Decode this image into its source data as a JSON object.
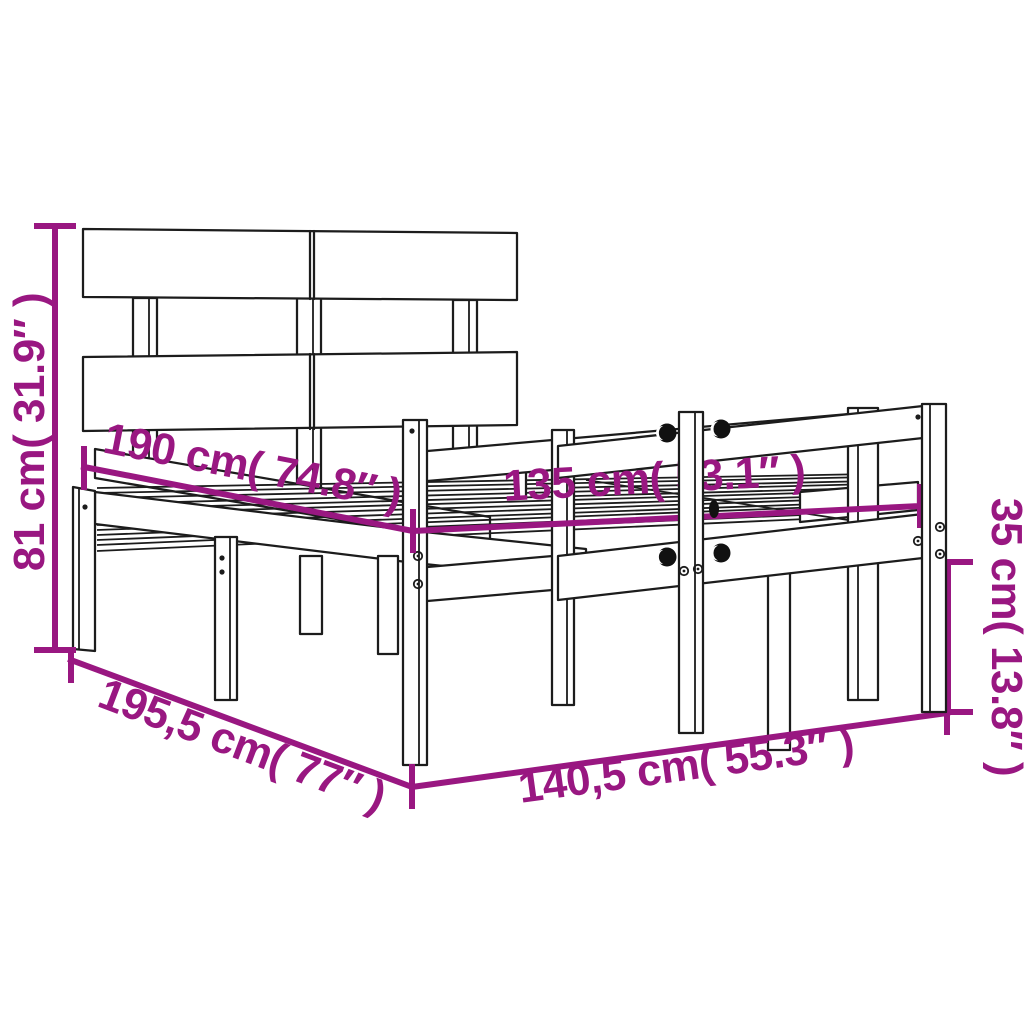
{
  "diagram": {
    "title": "Bed frame dimension drawing",
    "subject": "Wooden bed frame with headboard and side rails",
    "style": "black line art on white with magenta dimension callouts",
    "accent_color": "#991781",
    "line_color": "#1c1c1c",
    "background_color": "#ffffff",
    "dimensions": [
      {
        "id": "headboard-height",
        "value_cm": "81",
        "value_in": "31.9",
        "label": "81 cm( 31.9″ )"
      },
      {
        "id": "inner-length",
        "value_cm": "190",
        "value_in": "74.8",
        "label": "190 cm( 74.8″ )"
      },
      {
        "id": "inner-width",
        "value_cm": "135",
        "value_in": "53.1",
        "label": "135 cm( 53.1″ )"
      },
      {
        "id": "rail-height",
        "value_cm": "35",
        "value_in": "13.8",
        "label": "35 cm( 13.8″ )"
      },
      {
        "id": "outer-length",
        "value_cm": "195,5",
        "value_in": "77",
        "label": "195,5 cm( 77″ )"
      },
      {
        "id": "outer-width",
        "value_cm": "140,5",
        "value_in": "55.3",
        "label": "140,5 cm( 55.3″ )"
      }
    ]
  }
}
